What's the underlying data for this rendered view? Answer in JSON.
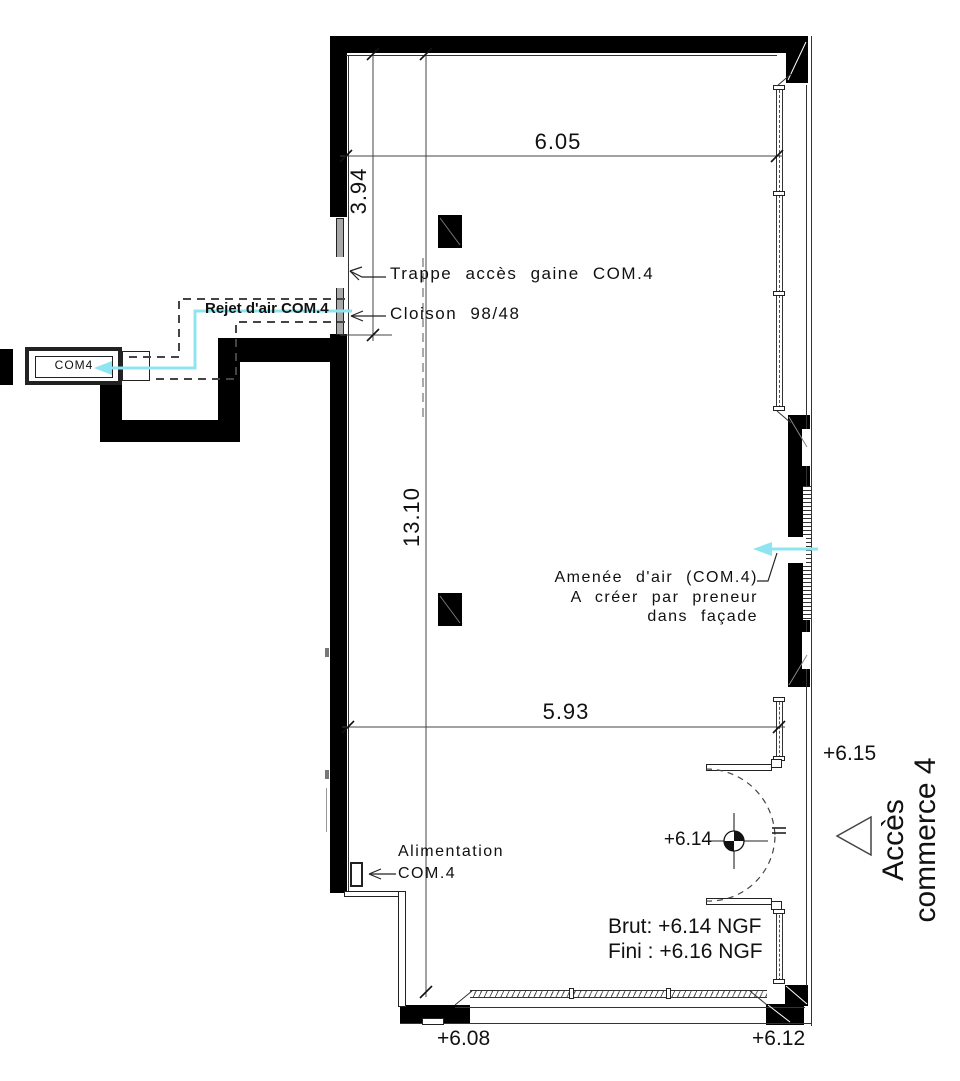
{
  "plan": {
    "duct_labels": {
      "rejet_air": "Rejet d'air COM.4",
      "com4_grille": "COM4",
      "trappe": "Trappe accès gaine COM.4",
      "cloison": "Cloison 98/48",
      "amenee_line1": "Amenée d'air (COM.4)",
      "amenee_line2": "A créer par preneur",
      "amenee_line3": "dans façade",
      "alimentation_line1": "Alimentation",
      "alimentation_line2": "COM.4"
    },
    "dimensions": {
      "top_width": "6.05",
      "upper_left_height": "3.94",
      "total_height": "13.10",
      "lower_width": "5.93"
    },
    "levels": {
      "outside_entrance": "+6.15",
      "door_point": "+6.14",
      "bottom_left": "+6.08",
      "bottom_right": "+6.12",
      "brut": "Brut: +6.14 NGF",
      "fini": "Fini : +6.16 NGF"
    },
    "access": {
      "line1": "Accès",
      "line2": "commerce 4"
    },
    "colors": {
      "wall": "#000000",
      "airflow": "#8ee4f0",
      "partition": "#a8a8a8"
    }
  }
}
